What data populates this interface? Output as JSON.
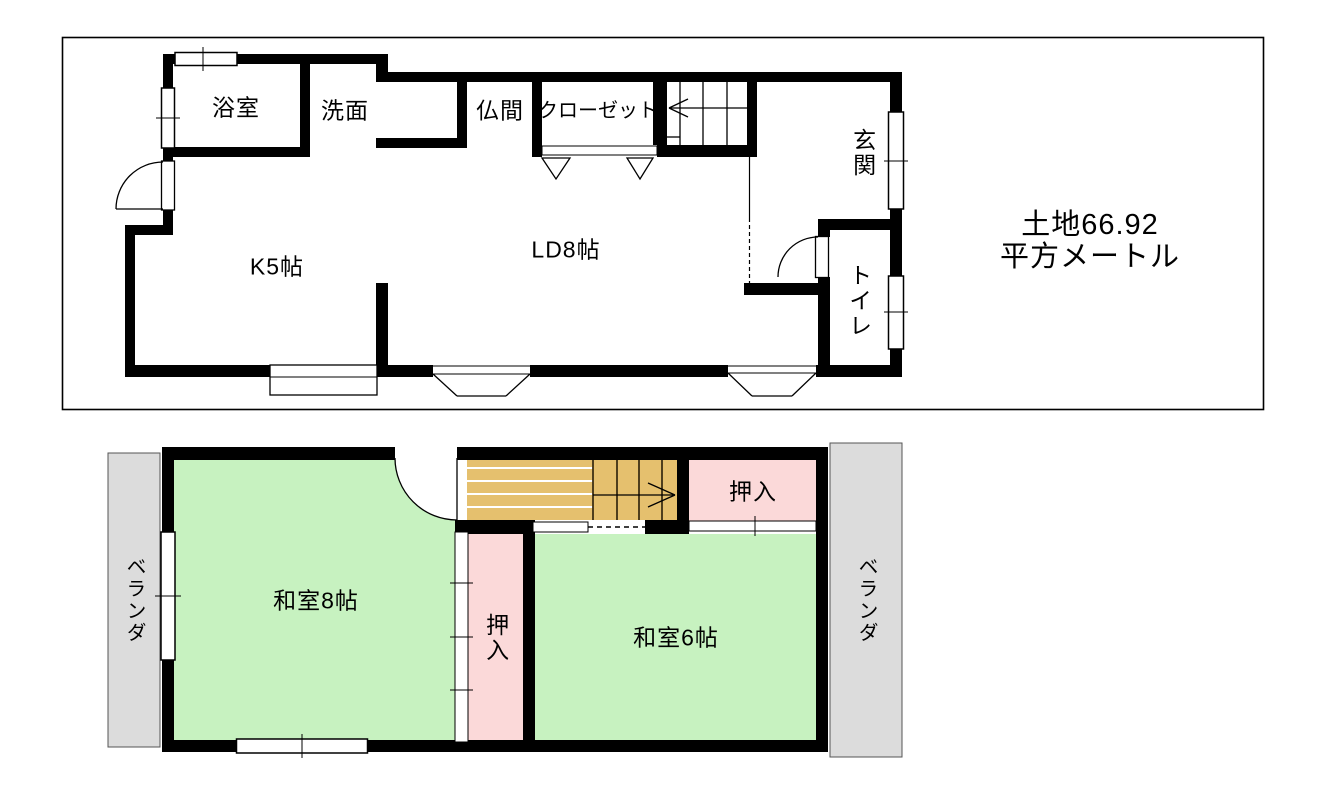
{
  "floor1": {
    "labels": {
      "bath": "浴室",
      "washroom": "洗面",
      "butsuma": "仏間",
      "closet": "クローゼット",
      "kitchen": "K5帖",
      "living_dining": "LD8帖",
      "entrance": "玄関",
      "toilet": "トイレ"
    },
    "land_area": {
      "line1": "土地66.92",
      "line2": "平方メートル"
    }
  },
  "floor2": {
    "labels": {
      "japanese_room_8": "和室8帖",
      "japanese_room_6": "和室6帖",
      "oshiire_upper": "押入",
      "oshiire_middle": "押入",
      "veranda_left": "ベランダ",
      "veranda_right": "ベランダ"
    }
  },
  "colors": {
    "tatami_green": "#c7f2c0",
    "closet_pink": "#fbd9d9",
    "stairs_tan": "#e5c06e",
    "veranda_gray": "#dcdcdc",
    "wall_black": "#000000"
  }
}
